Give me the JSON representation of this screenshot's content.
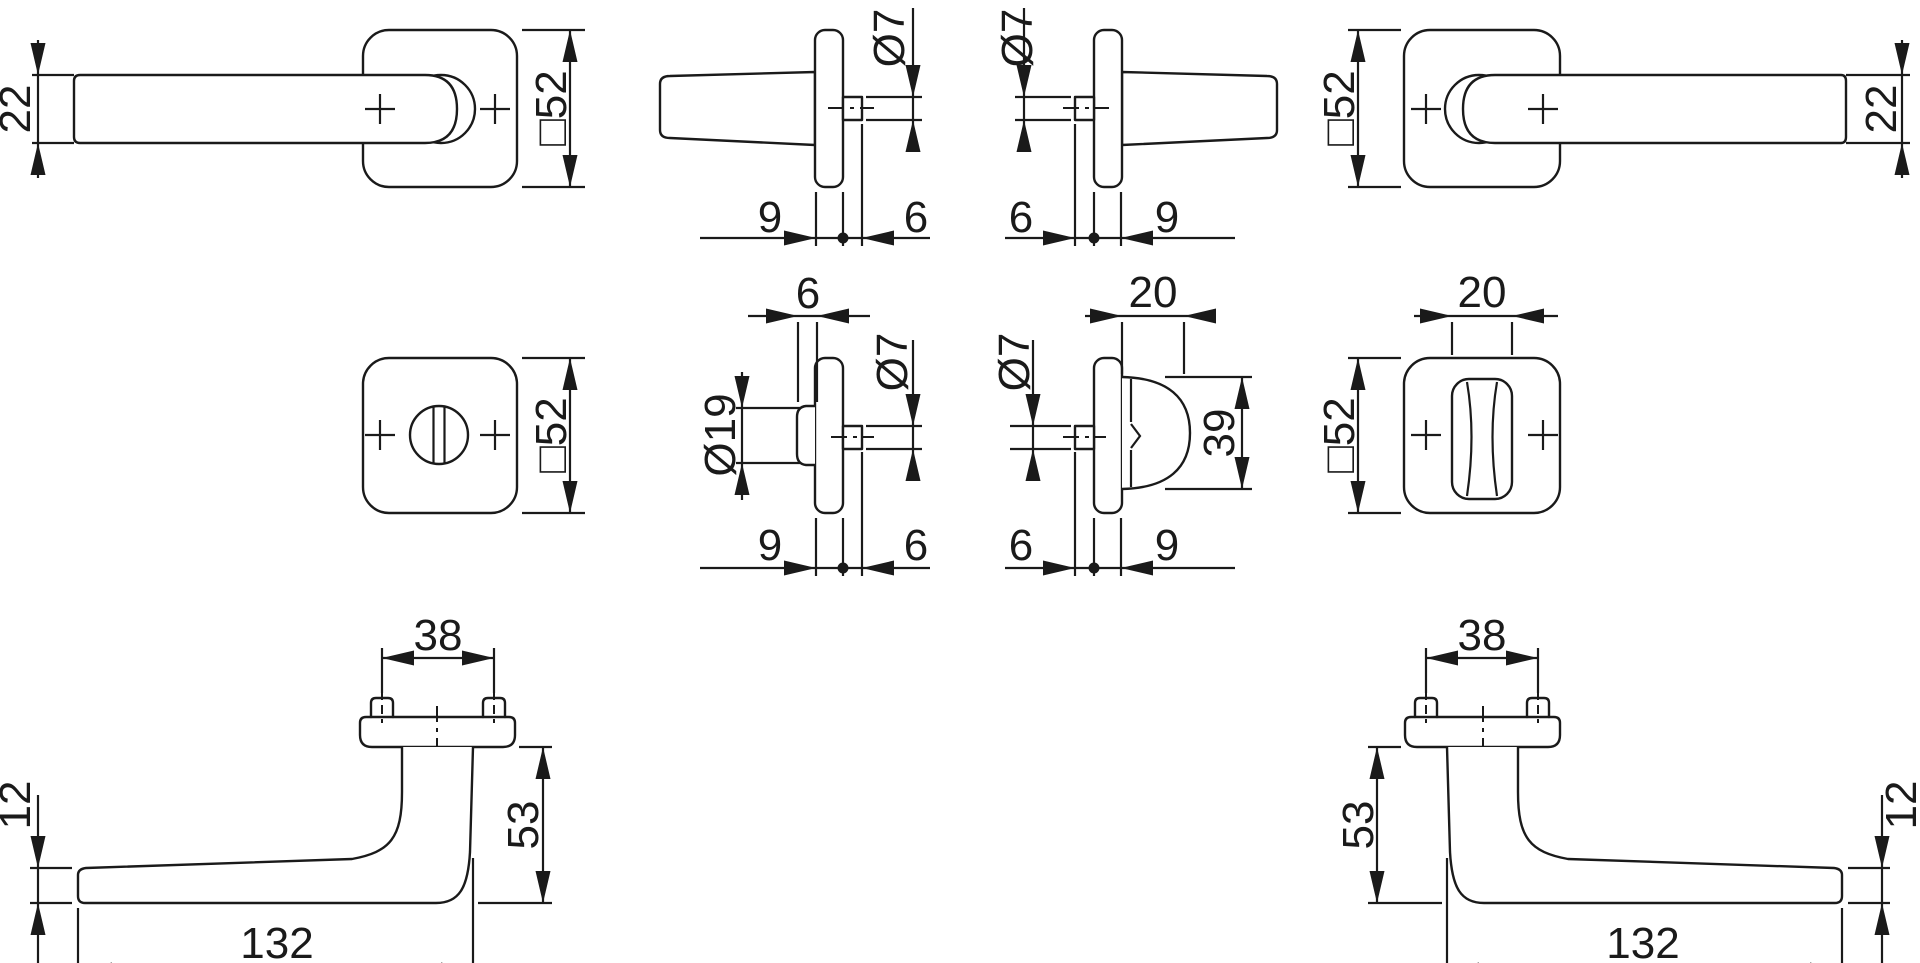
{
  "document": {
    "kind": "technical-dimension-drawing",
    "subject": "door handle set with square rosettes, side and front projections"
  },
  "colors": {
    "line": "#1a1a1a",
    "background": "#ffffff"
  },
  "figures": {
    "handle_front_left": {
      "grip_width": "22",
      "rose_size": "□52"
    },
    "handle_side_left": {
      "spindle_dia": "Ø7",
      "rose_depth": "9",
      "spindle_len": "6"
    },
    "handle_side_right": {
      "spindle_dia": "Ø7",
      "spindle_len": "6",
      "rose_depth": "9"
    },
    "handle_front_right": {
      "rose_size": "□52",
      "grip_width": "22"
    },
    "rose_front_left": {
      "rose_size": "□52"
    },
    "release_side": {
      "cap_depth": "6",
      "cap_dia": "Ø19",
      "spindle_dia": "Ø7",
      "rose_depth": "9",
      "spindle_len": "6"
    },
    "turn_side": {
      "spindle_dia": "Ø7",
      "wing_depth": "20",
      "wing_len": "39",
      "spindle_len": "6",
      "rose_depth": "9"
    },
    "turn_front": {
      "wing_depth": "20",
      "rose_size": "□52"
    },
    "profile_left": {
      "screw_spacing": "38",
      "grip_height": "12",
      "projection": "53",
      "length": "132"
    },
    "profile_right": {
      "screw_spacing": "38",
      "projection": "53",
      "grip_height": "12",
      "length": "132"
    }
  }
}
